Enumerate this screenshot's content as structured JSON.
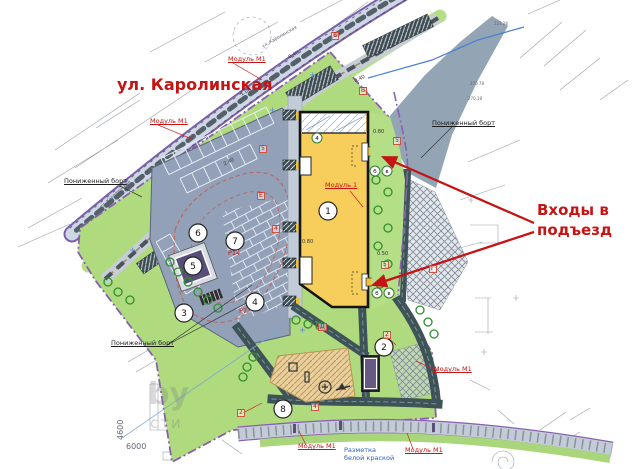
{
  "colors": {
    "annotation_red": "#c41414",
    "lawn_green": "#afdb7e",
    "building_yellow": "#f7ce5b",
    "parking_gray": "#92a0b8",
    "road_gray": "#cdd7e5",
    "boundary_purple": "#8a5fb0",
    "water_gray": "#93a5b4",
    "note_blue": "#2a5fc4",
    "dark_path": "#3d4f55",
    "playground_tan": "#e8cf9d",
    "module_purple": "#5c5178"
  },
  "annotations": {
    "street_name": "ул. Каролинская",
    "entrances_note_line1": "Входы в",
    "entrances_note_line2": "подъезд",
    "white_paint_line1": "Разметка",
    "white_paint_line2": "белой краской"
  },
  "map": {
    "labels": [
      {
        "name": "lowered-curb-label",
        "text": "Пониженный борт",
        "x": 64,
        "y": 178,
        "cls": "blk u"
      },
      {
        "name": "lowered-curb-label",
        "text": "Пониженный борт",
        "x": 111,
        "y": 340,
        "cls": "blk u"
      },
      {
        "name": "lowered-curb-label",
        "text": "Пониженный борт",
        "x": 432,
        "y": 120,
        "cls": "blk u"
      },
      {
        "name": "module-m1-label",
        "text": "Модуль М1",
        "x": 228,
        "y": 56,
        "cls": "red tag u"
      },
      {
        "name": "module-m1-label",
        "text": "Модуль М1",
        "x": 150,
        "y": 118,
        "cls": "red tag u"
      },
      {
        "name": "module-m1-label",
        "text": "Модуль М1",
        "x": 298,
        "y": 443,
        "cls": "red tag u"
      },
      {
        "name": "module-m1-label",
        "text": "Модуль М1",
        "x": 405,
        "y": 447,
        "cls": "red tag u"
      },
      {
        "name": "module-m1-label",
        "text": "Модуль М1",
        "x": 434,
        "y": 366,
        "cls": "red tag u"
      },
      {
        "name": "module-1-label",
        "text": "Модуль 1",
        "x": 325,
        "y": 182,
        "cls": "red tag u"
      },
      {
        "name": "parking-count-label",
        "text": "Р14",
        "x": 228,
        "y": 250,
        "cls": "red tag"
      },
      {
        "name": "parking-count-label",
        "text": "Р7",
        "x": 239,
        "y": 308,
        "cls": "red tag"
      },
      {
        "name": "ref-letter",
        "text": "Б",
        "x": 331,
        "y": 32,
        "cls": "red boxed"
      },
      {
        "name": "ref-letter",
        "text": "В",
        "x": 359,
        "y": 87,
        "cls": "red boxed"
      },
      {
        "name": "ref-letter",
        "text": "Е",
        "x": 257,
        "y": 192,
        "cls": "red boxed"
      },
      {
        "name": "ref-letter",
        "text": "Д",
        "x": 318,
        "y": 323,
        "cls": "red boxed"
      },
      {
        "name": "ref-letter",
        "text": "Г",
        "x": 429,
        "y": 265,
        "cls": "red boxed"
      },
      {
        "name": "ref-number",
        "text": "5",
        "x": 259,
        "y": 145,
        "cls": "red boxed"
      },
      {
        "name": "ref-number",
        "text": "5",
        "x": 393,
        "y": 137,
        "cls": "red boxed"
      },
      {
        "name": "ref-number",
        "text": "5",
        "x": 381,
        "y": 261,
        "cls": "red boxed"
      },
      {
        "name": "ref-number",
        "text": "4",
        "x": 272,
        "y": 225,
        "cls": "red boxed"
      },
      {
        "name": "ref-number",
        "text": "4",
        "x": 311,
        "y": 403,
        "cls": "red boxed"
      },
      {
        "name": "ref-number",
        "text": "2",
        "x": 237,
        "y": 409,
        "cls": "red boxed"
      },
      {
        "name": "ref-number",
        "text": "2",
        "x": 383,
        "y": 331,
        "cls": "red boxed"
      },
      {
        "name": "dimension-label",
        "text": "0.40",
        "x": 288,
        "y": 56,
        "cls": "dim",
        "rot": -28
      },
      {
        "name": "dimension-label",
        "text": "1.00",
        "x": 240,
        "y": 93,
        "cls": "dim",
        "rot": -28
      },
      {
        "name": "dimension-label",
        "text": "2.40",
        "x": 223,
        "y": 163,
        "cls": "dim",
        "rot": -28
      },
      {
        "name": "dimension-label",
        "text": "0.40",
        "x": 354,
        "y": 80,
        "cls": "dim",
        "rot": -28
      },
      {
        "name": "dimension-label",
        "text": "0.80",
        "x": 373,
        "y": 130,
        "cls": "dim"
      },
      {
        "name": "dimension-label",
        "text": "0.50",
        "x": 377,
        "y": 252,
        "cls": "dim"
      },
      {
        "name": "dimension-label",
        "text": "0.80",
        "x": 302,
        "y": 240,
        "cls": "dim"
      },
      {
        "name": "site-dimension",
        "text": "6000",
        "x": 126,
        "y": 443,
        "cls": "gray"
      },
      {
        "name": "site-dimension",
        "text": "4600",
        "x": 117,
        "y": 440,
        "cls": "gray",
        "rot": -90
      },
      {
        "name": "street-name-small",
        "text": "ул. Каролинская",
        "x": 262,
        "y": 46,
        "cls": "tiny",
        "rot": -30
      },
      {
        "name": "street-name-small",
        "text": "ул. Каролинская",
        "x": 100,
        "y": 207,
        "cls": "tiny",
        "rot": -42
      },
      {
        "name": "elevation-mark",
        "text": "221.26",
        "x": 494,
        "y": 22,
        "cls": "tiny2"
      },
      {
        "name": "elevation-mark",
        "text": "270.78",
        "x": 470,
        "y": 82,
        "cls": "tiny2"
      },
      {
        "name": "elevation-mark",
        "text": "270.18",
        "x": 468,
        "y": 97,
        "cls": "tiny2"
      },
      {
        "name": "watermark-fragment",
        "text": "by",
        "x": 148,
        "y": 380,
        "cls": "wm1"
      },
      {
        "name": "watermark-fragment",
        "text": "сти",
        "x": 150,
        "y": 416,
        "cls": "wm2"
      }
    ],
    "position_circles": [
      {
        "n": "1",
        "x": 328,
        "y": 211
      },
      {
        "n": "2",
        "x": 384,
        "y": 347
      },
      {
        "n": "3",
        "x": 184,
        "y": 313
      },
      {
        "n": "4",
        "x": 255,
        "y": 302
      },
      {
        "n": "5",
        "x": 193,
        "y": 266
      },
      {
        "n": "6",
        "x": 198,
        "y": 233
      },
      {
        "n": "7",
        "x": 235,
        "y": 241
      },
      {
        "n": "8",
        "x": 283,
        "y": 409
      }
    ],
    "letter_circles": [
      {
        "t": "б",
        "x": 375,
        "y": 171
      },
      {
        "t": "в",
        "x": 387,
        "y": 171
      },
      {
        "t": "б",
        "x": 377,
        "y": 293
      },
      {
        "t": "в",
        "x": 389,
        "y": 293
      },
      {
        "t": "4",
        "x": 317,
        "y": 138
      }
    ]
  }
}
